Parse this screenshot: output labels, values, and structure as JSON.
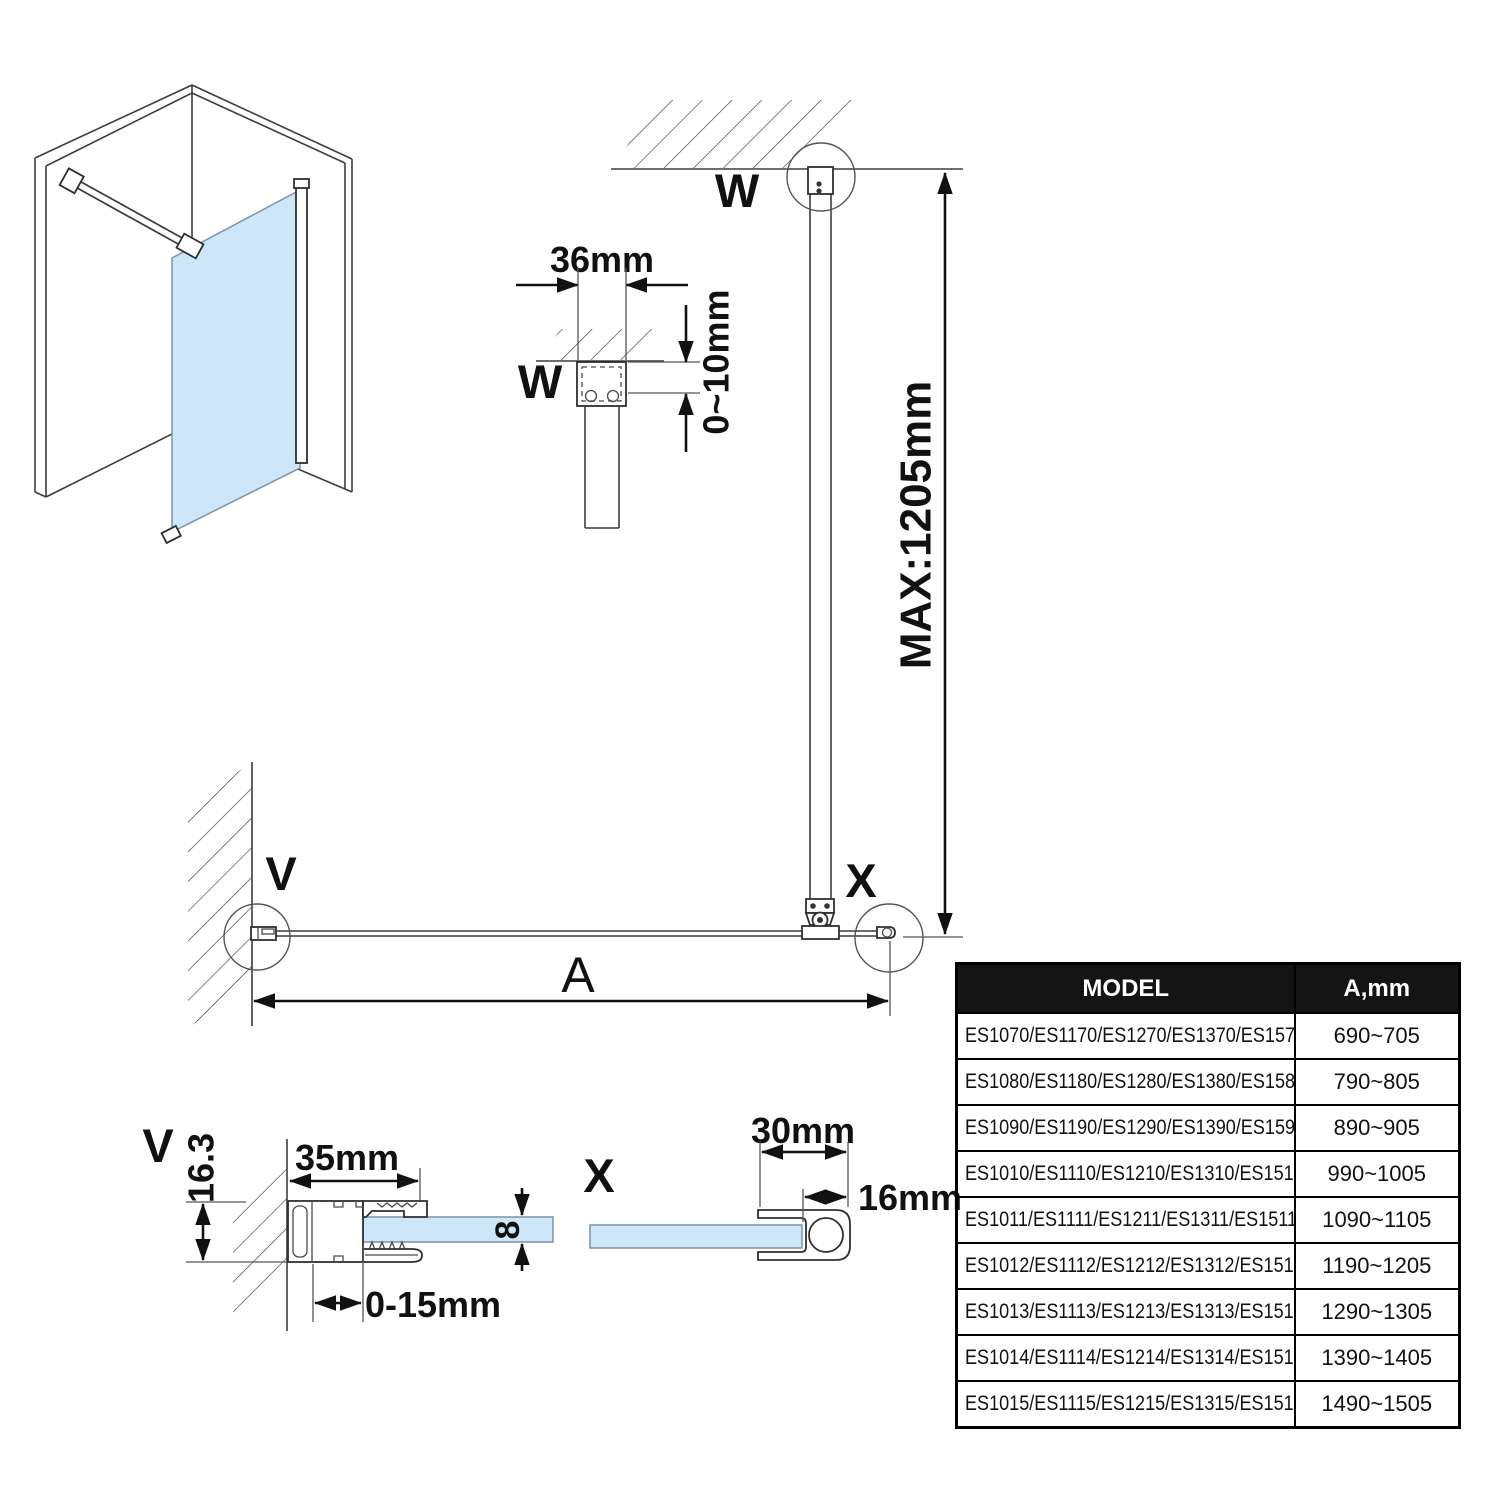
{
  "drawing": {
    "labels": {
      "w": "W",
      "v": "V",
      "x": "X",
      "a": "A"
    },
    "dims": {
      "d36": "36mm",
      "gap": "0~10mm",
      "max": "MAX:1205mm",
      "w35": "35mm",
      "d163": "16.3",
      "glass8": "8",
      "adj": "0-15mm",
      "d30": "30mm",
      "d16": "16mm"
    }
  },
  "colors": {
    "glass": "#cde7f8",
    "table_header_bg": "#141414",
    "table_header_fg": "#ffffff",
    "line": "#111111"
  },
  "table": {
    "headers": {
      "model": "MODEL",
      "a": "A,mm"
    },
    "rows": [
      {
        "model": "ES1070/ES1170/ES1270/ES1370/ES1570",
        "a": "690~705"
      },
      {
        "model": "ES1080/ES1180/ES1280/ES1380/ES1580",
        "a": "790~805"
      },
      {
        "model": "ES1090/ES1190/ES1290/ES1390/ES1590",
        "a": "890~905"
      },
      {
        "model": "ES1010/ES1110/ES1210/ES1310/ES1510",
        "a": "990~1005"
      },
      {
        "model": "ES1011/ES1111/ES1211/ES1311/ES1511",
        "a": "1090~1105"
      },
      {
        "model": "ES1012/ES1112/ES1212/ES1312/ES1512",
        "a": "1190~1205"
      },
      {
        "model": "ES1013/ES1113/ES1213/ES1313/ES1513",
        "a": "1290~1305"
      },
      {
        "model": "ES1014/ES1114/ES1214/ES1314/ES1514",
        "a": "1390~1405"
      },
      {
        "model": "ES1015/ES1115/ES1215/ES1315/ES1515",
        "a": "1490~1505"
      }
    ]
  }
}
